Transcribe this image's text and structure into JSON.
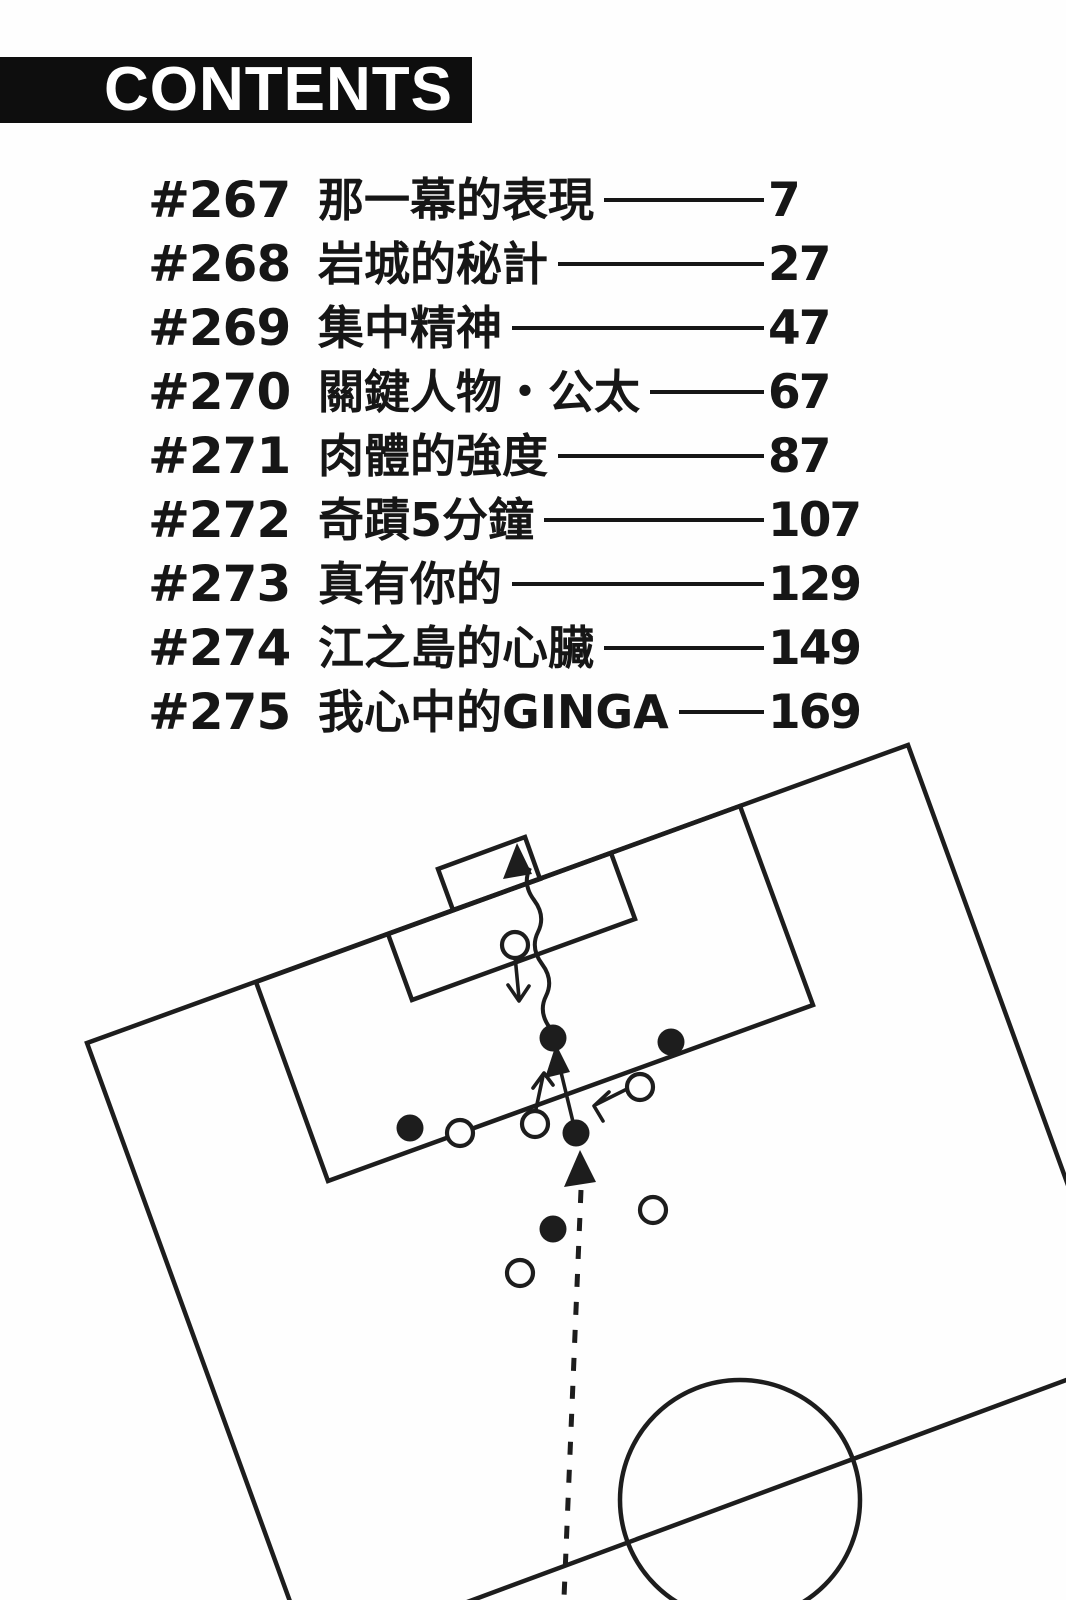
{
  "header": {
    "title": "CONTENTS",
    "bar_color": "#0e0e0e",
    "text_color": "#ffffff"
  },
  "toc": {
    "entries": [
      {
        "chapter": "#267",
        "title": "那一幕的表現",
        "page": "7"
      },
      {
        "chapter": "#268",
        "title": "岩城的秘計",
        "page": "27"
      },
      {
        "chapter": "#269",
        "title": "集中精神",
        "page": "47"
      },
      {
        "chapter": "#270",
        "title": "關鍵人物・公太",
        "page": "67"
      },
      {
        "chapter": "#271",
        "title": "肉體的強度",
        "page": "87"
      },
      {
        "chapter": "#272",
        "title": "奇蹟5分鐘",
        "page": "107"
      },
      {
        "chapter": "#273",
        "title": "真有你的",
        "page": "129"
      },
      {
        "chapter": "#274",
        "title": "江之島的心臟",
        "page": "149"
      },
      {
        "chapter": "#275",
        "title": "我心中的GINGA",
        "page": "169"
      }
    ]
  },
  "diagram": {
    "viewbox": "0 0 1066 1600",
    "ink_color": "#1d1d1d",
    "attacker_fill": "#1d1d1d",
    "defender_fill": "#fefefe",
    "shapes": [
      {
        "name": "field-boundary",
        "tag": "polyline",
        "attrs": {
          "points": "292,1607 87,1043 908,745 1113,1309",
          "class": "fl"
        }
      },
      {
        "name": "halfway-line",
        "tag": "path",
        "attrs": {
          "d": "M300,1664 L1131,1356",
          "class": "fl"
        }
      },
      {
        "name": "center-circle",
        "tag": "circle",
        "attrs": {
          "cx": 740,
          "cy": 1500,
          "r": 120,
          "class": "fl"
        }
      },
      {
        "name": "penalty-area",
        "tag": "polygon",
        "attrs": {
          "points": "256,982 740,806 813,1005 328,1181",
          "class": "fl"
        }
      },
      {
        "name": "goal-area",
        "tag": "polygon",
        "attrs": {
          "points": "388,934 611,853 635,919 412,1000",
          "class": "fl"
        }
      },
      {
        "name": "goal-box",
        "tag": "polygon",
        "attrs": {
          "points": "438,869 525,837 540,879 453,910",
          "class": "fl"
        }
      },
      {
        "name": "shot-squiggle-line",
        "tag": "path",
        "attrs": {
          "d": "M550,1028 Q538,1012 546,996 Q554,980 542,964 Q530,948 538,932 Q546,916 534,900 Q522,884 530,868",
          "class": "wavy"
        }
      },
      {
        "name": "shot-arrowhead",
        "tag": "polygon",
        "attrs": {
          "points": "517,843 503,879 532,874",
          "class": "head"
        }
      },
      {
        "name": "run-arrow-line",
        "tag": "path",
        "attrs": {
          "d": "M574,1126 L560,1068",
          "class": "thin"
        }
      },
      {
        "name": "run-arrowhead",
        "tag": "polygon",
        "attrs": {
          "points": "556,1044 545,1078 570,1072",
          "class": "head"
        }
      },
      {
        "name": "pass-dashed-line",
        "tag": "path",
        "attrs": {
          "d": "M581,1190 L564,1598",
          "class": "dash"
        }
      },
      {
        "name": "pass-arrowhead",
        "tag": "polygon",
        "attrs": {
          "points": "580,1150 564,1187 596,1182",
          "class": "head"
        }
      },
      {
        "name": "keeper-arrow-line",
        "tag": "path",
        "attrs": {
          "d": "M515,956 L519,998",
          "class": "thin"
        }
      },
      {
        "name": "keeper-arrowhead",
        "tag": "path",
        "attrs": {
          "d": "M508,985 L519,1001 L529,986",
          "class": "thin"
        }
      },
      {
        "name": "defender-arrow-line",
        "tag": "path",
        "attrs": {
          "d": "M627,1089 L597,1104",
          "class": "thin"
        }
      },
      {
        "name": "defender-arrowhead",
        "tag": "path",
        "attrs": {
          "d": "M609,1092 L594,1106 L603,1121",
          "class": "thin"
        }
      },
      {
        "name": "midfielder-arrow-line",
        "tag": "path",
        "attrs": {
          "d": "M536,1109 L543,1076",
          "class": "thin"
        }
      },
      {
        "name": "midfielder-arrowhead",
        "tag": "path",
        "attrs": {
          "d": "M533,1088 L544,1073 L553,1085",
          "class": "thin"
        }
      },
      {
        "name": "attacker-marker",
        "tag": "circle",
        "attrs": {
          "cx": 553,
          "cy": 1038,
          "r": 13.5,
          "class": "pa"
        }
      },
      {
        "name": "attacker-marker",
        "tag": "circle",
        "attrs": {
          "cx": 671,
          "cy": 1042,
          "r": 13.5,
          "class": "pa"
        }
      },
      {
        "name": "attacker-marker",
        "tag": "circle",
        "attrs": {
          "cx": 410,
          "cy": 1128,
          "r": 13.5,
          "class": "pa"
        }
      },
      {
        "name": "attacker-marker",
        "tag": "circle",
        "attrs": {
          "cx": 576,
          "cy": 1133,
          "r": 13.5,
          "class": "pa"
        }
      },
      {
        "name": "attacker-marker",
        "tag": "circle",
        "attrs": {
          "cx": 553,
          "cy": 1229,
          "r": 13.5,
          "class": "pa"
        }
      },
      {
        "name": "goalkeeper-marker",
        "tag": "circle",
        "attrs": {
          "cx": 515,
          "cy": 945,
          "r": 13,
          "class": "pd"
        }
      },
      {
        "name": "defender-marker",
        "tag": "circle",
        "attrs": {
          "cx": 640,
          "cy": 1087,
          "r": 13,
          "class": "pd"
        }
      },
      {
        "name": "defender-marker",
        "tag": "circle",
        "attrs": {
          "cx": 535,
          "cy": 1124,
          "r": 13,
          "class": "pd"
        }
      },
      {
        "name": "defender-marker",
        "tag": "circle",
        "attrs": {
          "cx": 460,
          "cy": 1133,
          "r": 13,
          "class": "pd"
        }
      },
      {
        "name": "defender-marker",
        "tag": "circle",
        "attrs": {
          "cx": 653,
          "cy": 1210,
          "r": 13,
          "class": "pd"
        }
      },
      {
        "name": "defender-marker",
        "tag": "circle",
        "attrs": {
          "cx": 520,
          "cy": 1273,
          "r": 13,
          "class": "pd"
        }
      }
    ]
  }
}
